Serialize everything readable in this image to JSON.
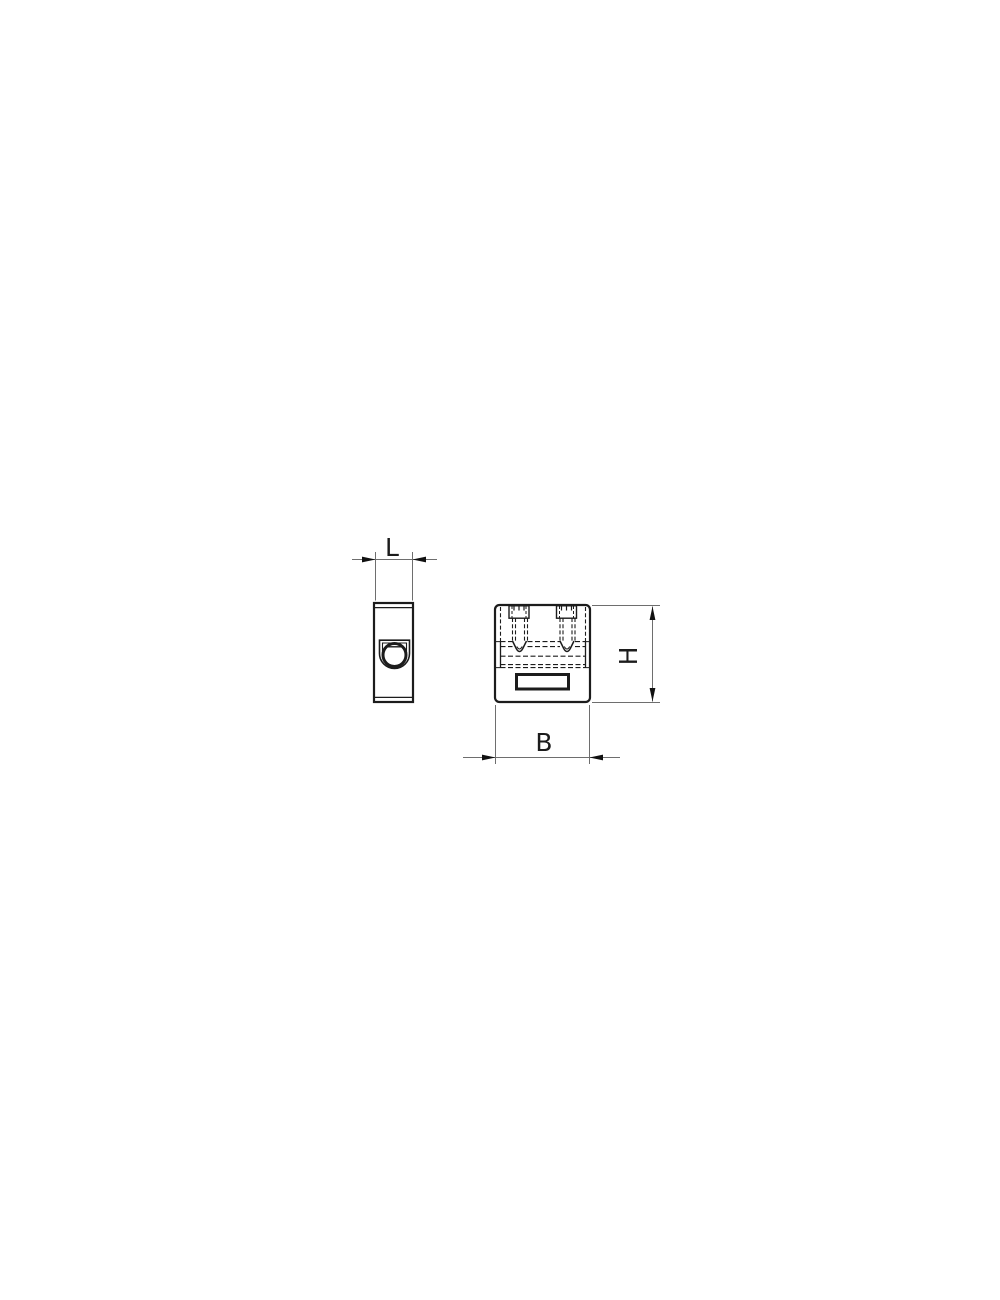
{
  "drawing": {
    "dimension_labels": {
      "length": "L",
      "width": "B",
      "height": "H"
    },
    "colors": {
      "line": "#1c1c1c",
      "hidden_line": "#2a2a2a",
      "dimension_line": "#6e6e6e",
      "arrow": "#111111",
      "background": "#ffffff"
    }
  }
}
